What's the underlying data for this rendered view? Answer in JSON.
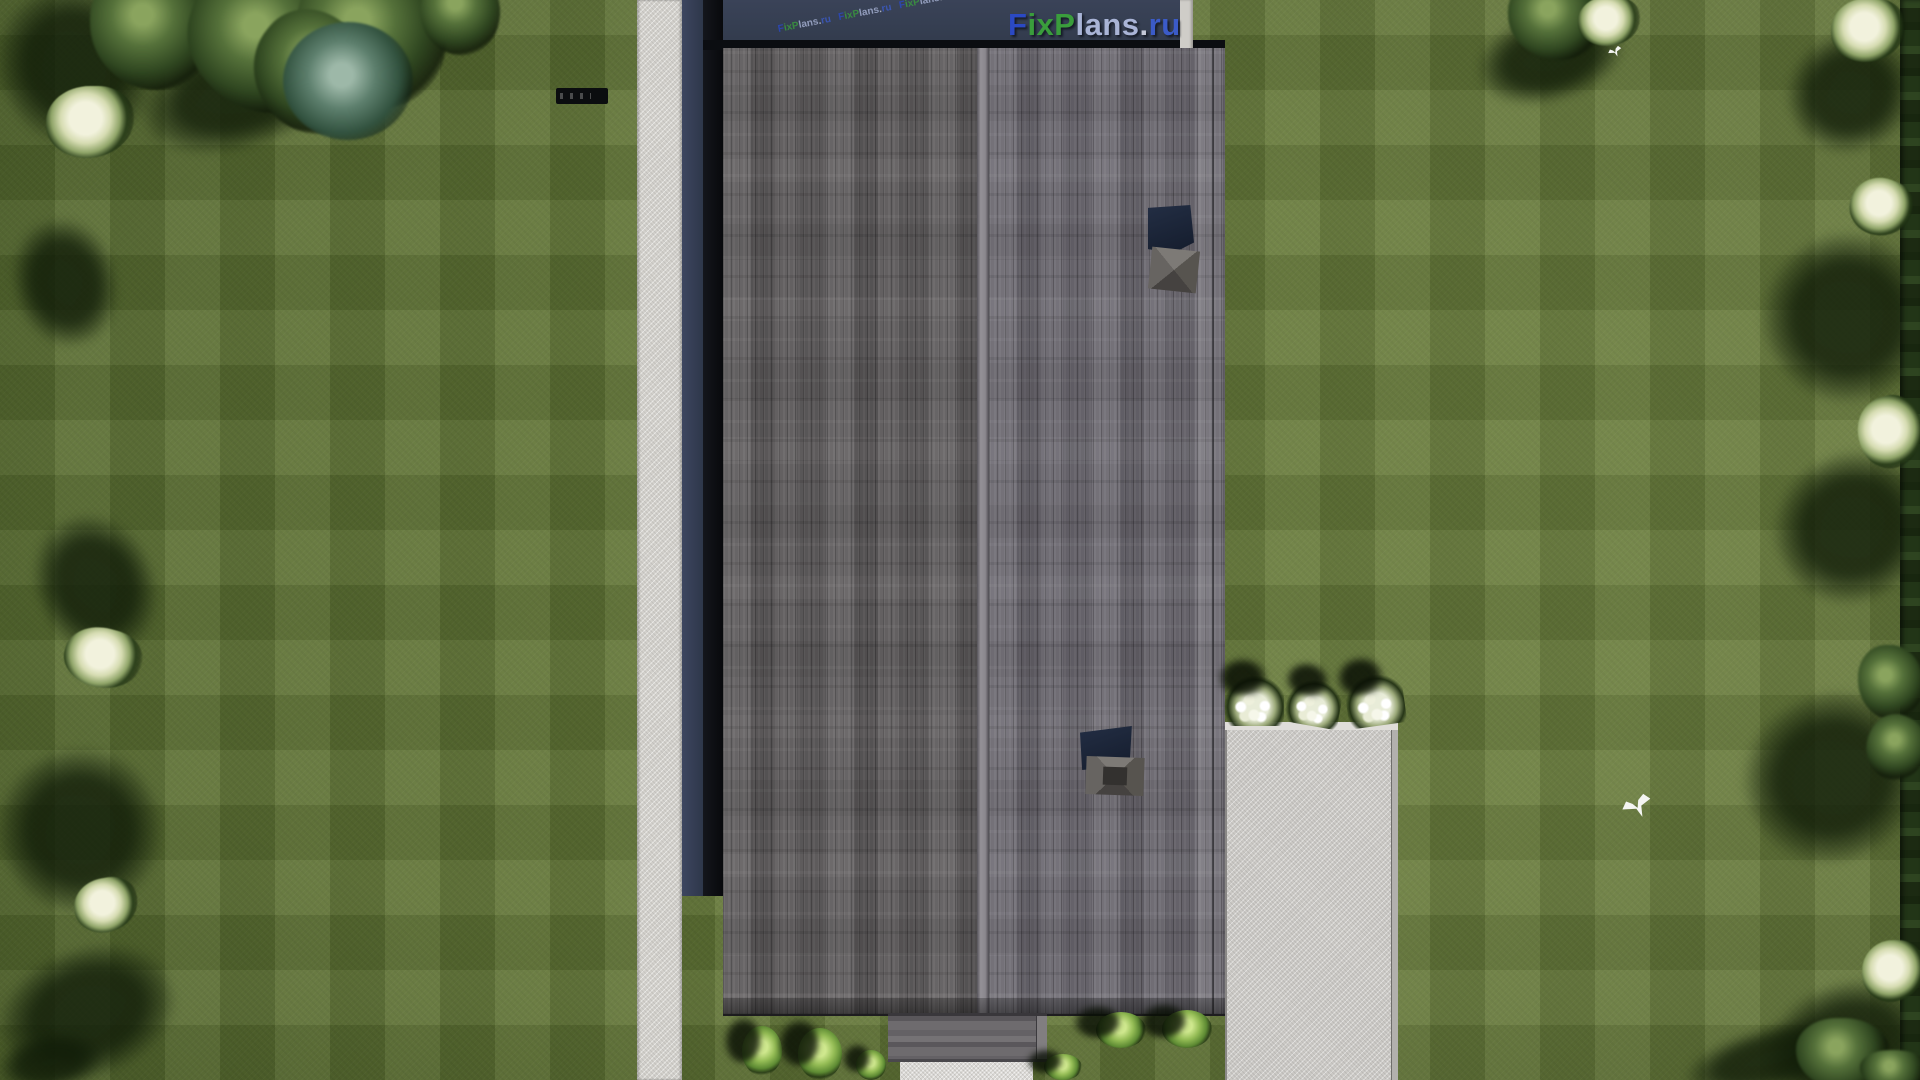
{
  "watermark": {
    "full": "FixPlans.ru",
    "f": "F",
    "ix": "ix",
    "p": "P",
    "lans": "lans",
    "dot": ".",
    "ru": "ru"
  },
  "palette": {
    "grass_base": "#617437",
    "path": "#d2d0cb",
    "wall_shadow_navy": "#353e50",
    "roof_drop_black": "#0b0d11",
    "roof_left": "#5e5b5c",
    "roof_right": "#6b6870",
    "ridge": "#8f8c8e",
    "patio": "#cbc9c5",
    "steps": "#dad8d4",
    "porch": "#6e6b6e",
    "chimney_shadow": "#1c2536",
    "chimney_cap_light": "#7d7a76",
    "chimney_cap_dark": "#454240",
    "hedge": "#233517",
    "bush": "#94bc55",
    "flower": "#f0f2e2",
    "tree_dark": "#2f4620",
    "tree_pale": "#f2f2dd",
    "sliver": "#cfcdc8",
    "bird": "#f4f5f2",
    "wm_blue": "#2b49c4",
    "wm_green": "#3a9d3c",
    "wm_pale": "#a9b4d6",
    "wm_dot": "#c4c9d8",
    "wm_ru": "#3b5bc8"
  },
  "scenery": [
    {
      "kind": "shadow",
      "x": 0,
      "y": -15,
      "w": 150,
      "h": 160,
      "r": -30
    },
    {
      "kind": "shadow",
      "x": 140,
      "y": 35,
      "w": 210,
      "h": 110,
      "r": -18
    },
    {
      "kind": "shadow",
      "x": 15,
      "y": 220,
      "w": 100,
      "h": 125,
      "r": -15
    },
    {
      "kind": "shadow",
      "x": 38,
      "y": 515,
      "w": 115,
      "h": 140,
      "r": -25
    },
    {
      "kind": "shadow",
      "x": 0,
      "y": 750,
      "w": 160,
      "h": 160,
      "r": -30
    },
    {
      "kind": "shadow",
      "x": 0,
      "y": 950,
      "w": 175,
      "h": 125,
      "r": -20
    },
    {
      "kind": "shadow",
      "x": 0,
      "y": 1035,
      "w": 100,
      "h": 55,
      "r": -10
    },
    {
      "kind": "shadow",
      "x": 1478,
      "y": 15,
      "w": 145,
      "h": 85,
      "r": -15
    },
    {
      "kind": "shadow",
      "x": 1788,
      "y": 35,
      "w": 125,
      "h": 115,
      "r": -25
    },
    {
      "kind": "shadow",
      "x": 1765,
      "y": 235,
      "w": 165,
      "h": 165,
      "r": -35
    },
    {
      "kind": "shadow",
      "x": 1775,
      "y": 455,
      "w": 155,
      "h": 145,
      "r": -30
    },
    {
      "kind": "shadow",
      "x": 1745,
      "y": 695,
      "w": 175,
      "h": 165,
      "r": -25
    },
    {
      "kind": "shadow",
      "x": 1765,
      "y": 985,
      "w": 165,
      "h": 125,
      "r": -20
    },
    {
      "kind": "shadow",
      "x": 1685,
      "y": 1028,
      "w": 175,
      "h": 60,
      "r": -15
    },
    {
      "kind": "hedge",
      "x": 1900,
      "y": 0,
      "w": 20,
      "h": 1080,
      "r": 0
    },
    {
      "kind": "treedark",
      "x": 90,
      "y": -35,
      "w": 125,
      "h": 125,
      "r": 0
    },
    {
      "kind": "treedark",
      "x": 185,
      "y": -25,
      "w": 155,
      "h": 135,
      "r": 20
    },
    {
      "kind": "treedark",
      "x": 300,
      "y": -45,
      "w": 145,
      "h": 155,
      "r": -15
    },
    {
      "kind": "treedark",
      "x": 250,
      "y": 15,
      "w": 125,
      "h": 115,
      "r": 40
    },
    {
      "kind": "treedark",
      "x": 420,
      "y": -30,
      "w": 80,
      "h": 85,
      "r": 10
    },
    {
      "kind": "treeteal",
      "x": 283,
      "y": 22,
      "w": 130,
      "h": 118,
      "r": 0
    },
    {
      "kind": "treedark",
      "x": 1508,
      "y": -25,
      "w": 95,
      "h": 85,
      "r": 0
    },
    {
      "kind": "treedark",
      "x": 1858,
      "y": 645,
      "w": 65,
      "h": 75,
      "r": 0
    },
    {
      "kind": "treedark",
      "x": 1866,
      "y": 715,
      "w": 60,
      "h": 65,
      "r": 25
    },
    {
      "kind": "treedark",
      "x": 1796,
      "y": 1018,
      "w": 95,
      "h": 72,
      "r": 0
    },
    {
      "kind": "treedark",
      "x": 1860,
      "y": 1050,
      "w": 70,
      "h": 40,
      "r": 0
    },
    {
      "kind": "treewhite",
      "x": 46,
      "y": 86,
      "w": 88,
      "h": 72,
      "r": 0
    },
    {
      "kind": "treewhite",
      "x": 64,
      "y": 628,
      "w": 78,
      "h": 60,
      "r": 15
    },
    {
      "kind": "treewhite",
      "x": 74,
      "y": 878,
      "w": 64,
      "h": 54,
      "r": -10
    },
    {
      "kind": "treewhite",
      "x": 1831,
      "y": -2,
      "w": 74,
      "h": 64,
      "r": 0
    },
    {
      "kind": "treewhite",
      "x": 1850,
      "y": 178,
      "w": 62,
      "h": 58,
      "r": 20
    },
    {
      "kind": "treewhite",
      "x": 1858,
      "y": 396,
      "w": 64,
      "h": 72,
      "r": -15
    },
    {
      "kind": "treewhite",
      "x": 1862,
      "y": 940,
      "w": 62,
      "h": 62,
      "r": 0
    },
    {
      "kind": "treewhite",
      "x": 1578,
      "y": -4,
      "w": 62,
      "h": 50,
      "r": 0
    },
    {
      "kind": "flower",
      "x": 1224,
      "y": 676,
      "w": 60,
      "h": 50,
      "r": 0
    },
    {
      "kind": "flower",
      "x": 1287,
      "y": 680,
      "w": 54,
      "h": 46,
      "r": 10
    },
    {
      "kind": "flower",
      "x": 1346,
      "y": 674,
      "w": 58,
      "h": 52,
      "r": -8
    },
    {
      "kind": "bush",
      "x": 742,
      "y": 1026,
      "w": 40,
      "h": 50,
      "r": 0
    },
    {
      "kind": "bush",
      "x": 798,
      "y": 1028,
      "w": 44,
      "h": 52,
      "r": 0
    },
    {
      "kind": "bush",
      "x": 856,
      "y": 1050,
      "w": 30,
      "h": 30,
      "r": 0
    },
    {
      "kind": "bush",
      "x": 1044,
      "y": 1054,
      "w": 38,
      "h": 26,
      "r": 0
    },
    {
      "kind": "bush",
      "x": 1096,
      "y": 1012,
      "w": 50,
      "h": 36,
      "r": 0
    },
    {
      "kind": "bush",
      "x": 1162,
      "y": 1010,
      "w": 50,
      "h": 38,
      "r": 0
    },
    {
      "kind": "bird",
      "x": 1622,
      "y": 794,
      "w": 30,
      "h": 24,
      "r": 0
    },
    {
      "kind": "bird",
      "x": 1608,
      "y": 46,
      "w": 14,
      "h": 11,
      "r": 0
    }
  ]
}
